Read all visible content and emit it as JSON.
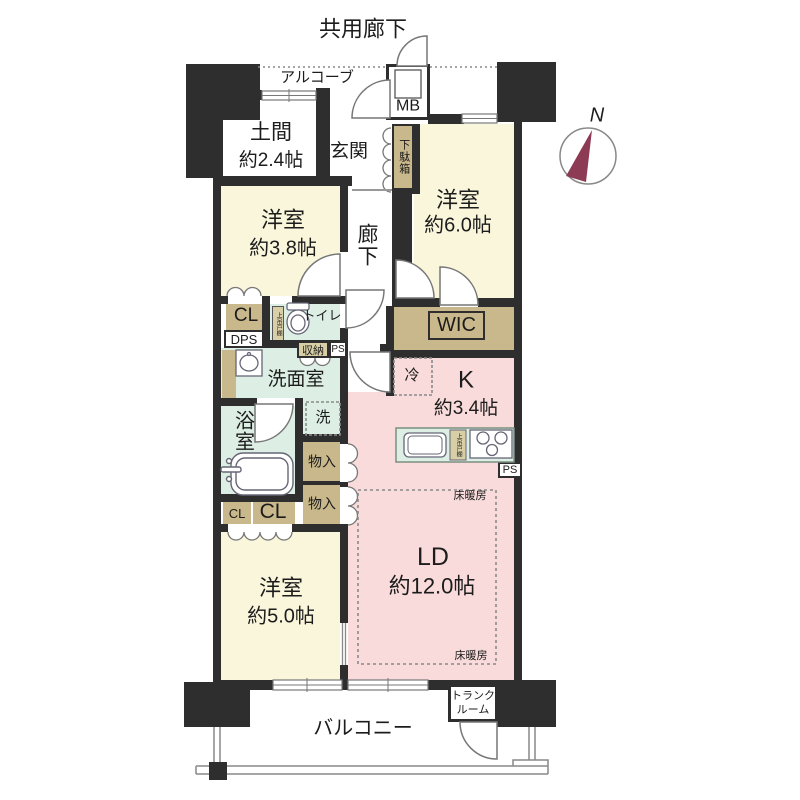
{
  "header": {
    "title": "共用廊下"
  },
  "compass": {
    "label": "N",
    "needle_color": "#8d3a55"
  },
  "colors": {
    "wall": "#2e2e2e",
    "room_cream": "#faf6dc",
    "room_pink": "#fadbdb",
    "room_green": "#ddefe5",
    "closet_tan": "#c9b88b",
    "needle": "#8d3a55"
  },
  "rooms": {
    "alcove": {
      "label": "アルコーブ"
    },
    "meter_box": {
      "label": "MB"
    },
    "doma": {
      "label": "土間",
      "size": "約2.4帖"
    },
    "genkan": {
      "label": "玄関"
    },
    "getabako": {
      "label": "下駄箱"
    },
    "western_3_8": {
      "label": "洋室",
      "size": "約3.8帖"
    },
    "corridor": {
      "label": "廊下"
    },
    "western_6_0": {
      "label": "洋室",
      "size": "約6.0帖"
    },
    "cl_upper": {
      "label": "CL"
    },
    "dps": {
      "label": "DPS"
    },
    "toilet": {
      "label": "トイレ"
    },
    "shelf_toilet": {
      "label": "上吊戸棚"
    },
    "storage_shuno": {
      "label": "収納"
    },
    "ps_upper": {
      "label": "PS"
    },
    "wic": {
      "label": "WIC"
    },
    "washroom": {
      "label": "洗面室"
    },
    "washer": {
      "label": "洗"
    },
    "bathroom": {
      "label": "浴室"
    },
    "fridge": {
      "label": "冷"
    },
    "kitchen": {
      "label": "K",
      "size": "約3.4帖"
    },
    "shelf_kitchen": {
      "label": "上吊戸棚"
    },
    "ps_kitchen": {
      "label": "PS"
    },
    "monoire_1": {
      "label": "物入"
    },
    "monoire_2": {
      "label": "物入"
    },
    "cl_small": {
      "label": "CL"
    },
    "cl_large": {
      "label": "CL"
    },
    "western_5_0": {
      "label": "洋室",
      "size": "約5.0帖"
    },
    "living_dining": {
      "label": "LD",
      "size": "約12.0帖"
    },
    "floor_heating_top": {
      "label": "床暖房"
    },
    "floor_heating_bottom": {
      "label": "床暖房"
    },
    "trunk_room": {
      "label": "トランク",
      "label2": "ルーム"
    },
    "balcony": {
      "label": "バルコニー"
    }
  }
}
